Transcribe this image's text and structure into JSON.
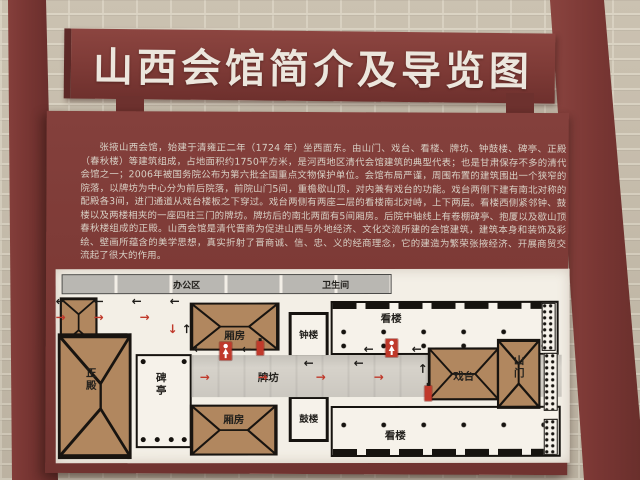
{
  "board": {
    "title": "山西会馆简介及导览图",
    "intro": "张掖山西会馆，始建于清雍正二年（1724 年）坐西面东。由山门、戏台、看楼、牌坊、钟鼓楼、碑亭、正殿（春秋楼）等建筑组成，占地面积约1750平方米，是河西地区清代会馆建筑的典型代表；也是甘肃保存不多的清代会馆之一；2006年被国务院公布为第六批全国重点文物保护单位。会馆布局严谨，周围布置的建筑围出一个狭窄的院落，以牌坊为中心分为前后院落，前院山门5间，重檐歇山顶，对内兼有戏台的功能。戏台两侧下建有南北对称的配殿各3间，进门通道从戏台楼板之下穿过。戏台两侧有两座二层的看楼南北对峙，上下两层。看楼西侧紧邻钟、鼓楼以及两楼相夹的一座四柱三门的牌坊。牌坊后的南北两面有5间厢房。后院中轴线上有卷棚碑亭、抱厦以及歇山顶春秋楼组成的正殿。山西会馆是清代晋商为促进山西与外地经济、文化交流所建的会馆建筑，建筑本身和装饰及彩绘、壁画所蕴含的美学思想，真实折射了晋商诚、信、忠、义的经商理念，它的建造为繁荣张掖经济、开展商贸交流起了很大的作用。"
  },
  "map": {
    "areas": {
      "office": "办公区",
      "restroom": "卫生间"
    },
    "buildings": {
      "main_hall": "正殿",
      "stele_pavilion": "碑亭",
      "wing_room_north": "厢房",
      "wing_room_south": "厢房",
      "bell_tower": "钟楼",
      "drum_tower": "鼓楼",
      "gallery_north": "看楼",
      "gallery_south": "看楼",
      "archway": "牌坊",
      "stage": "戏台",
      "gate": "山门"
    },
    "glyphs": {
      "left": "←",
      "right": "→",
      "up": "↑",
      "down": "↓"
    },
    "colors": {
      "board_maroon": "#7d3a36",
      "panel_white": "#f3efe6",
      "roof_brown": "#b1875f",
      "arrow_red": "#c0392b",
      "arrow_black": "#1d1b18",
      "walkway_grey": "#d6d2ca"
    },
    "icons": [
      "restroom-sign-icon",
      "fire-extinguisher-icon"
    ]
  }
}
